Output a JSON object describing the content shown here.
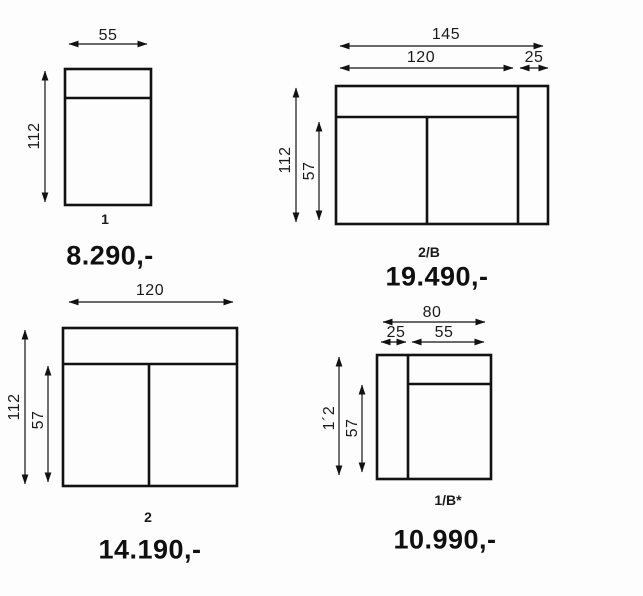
{
  "diagram": {
    "background_color": "#fdfdfd",
    "line_color": "#121212",
    "text_color": "#1a1a1a"
  },
  "modules": [
    {
      "label": "1",
      "price": "8.290,-",
      "dims": {
        "width": "55",
        "height": "112"
      }
    },
    {
      "label": "2/B",
      "price": "19.490,-",
      "dims": {
        "total_width": "145",
        "seat_width": "120",
        "arm_width": "25",
        "height": "112",
        "seat_height": "57"
      }
    },
    {
      "label": "2",
      "price": "14.190,-",
      "dims": {
        "width": "120",
        "height": "112",
        "seat_height": "57"
      }
    },
    {
      "label": "1/B*",
      "price": "10.990,-",
      "dims": {
        "total_width": "80",
        "arm_width": "25",
        "seat_width": "55",
        "height": "1´2",
        "seat_height": "57"
      }
    }
  ]
}
